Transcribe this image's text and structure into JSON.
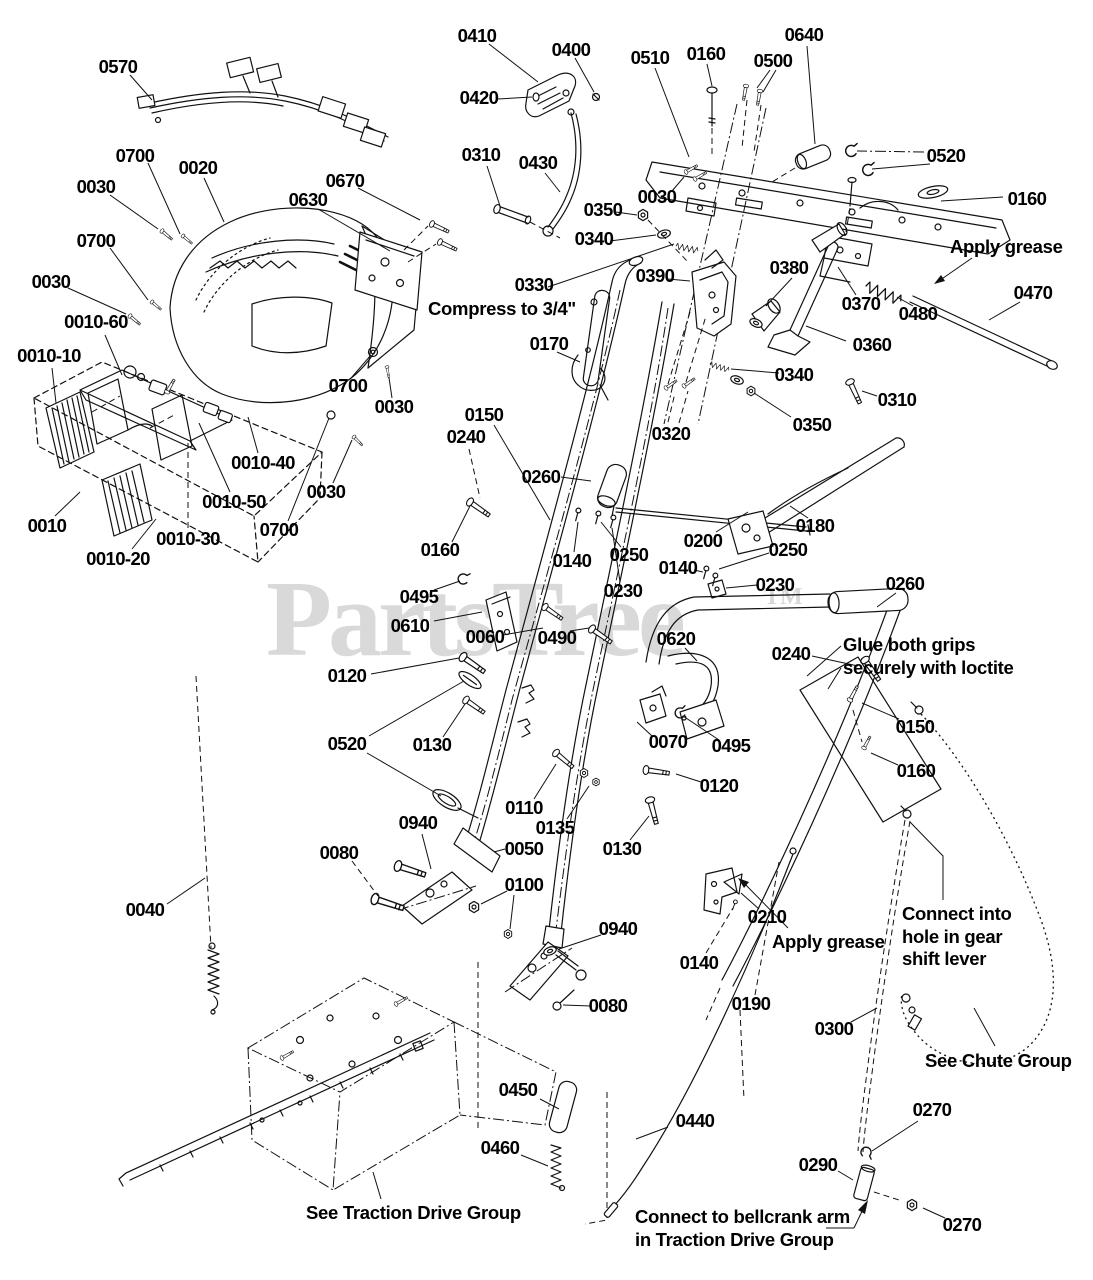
{
  "watermark": {
    "text": "PartsTree",
    "tm": "TM",
    "color": "#d9d9d9"
  },
  "diagram": {
    "background": "#ffffff",
    "line_color": "#111111"
  },
  "callouts": [
    {
      "type": "part",
      "text": "0570",
      "x": 118,
      "y": 67
    },
    {
      "type": "part",
      "text": "0700",
      "x": 135,
      "y": 156
    },
    {
      "type": "part",
      "text": "0020",
      "x": 198,
      "y": 168
    },
    {
      "type": "part",
      "text": "0030",
      "x": 96,
      "y": 187
    },
    {
      "type": "part",
      "text": "0670",
      "x": 345,
      "y": 181
    },
    {
      "type": "part",
      "text": "0630",
      "x": 308,
      "y": 200
    },
    {
      "type": "part",
      "text": "0700",
      "x": 96,
      "y": 241
    },
    {
      "type": "part",
      "text": "0030",
      "x": 51,
      "y": 282
    },
    {
      "type": "part",
      "text": "0010-60",
      "x": 96,
      "y": 322
    },
    {
      "type": "part",
      "text": "0010-10",
      "x": 49,
      "y": 356
    },
    {
      "type": "part",
      "text": "0700",
      "x": 348,
      "y": 386
    },
    {
      "type": "part",
      "text": "0030",
      "x": 394,
      "y": 407
    },
    {
      "type": "part",
      "text": "0010-40",
      "x": 263,
      "y": 463
    },
    {
      "type": "part",
      "text": "0010-50",
      "x": 234,
      "y": 502
    },
    {
      "type": "part",
      "text": "0030",
      "x": 326,
      "y": 492
    },
    {
      "type": "part",
      "text": "0010",
      "x": 47,
      "y": 526
    },
    {
      "type": "part",
      "text": "0010-30",
      "x": 188,
      "y": 539
    },
    {
      "type": "part",
      "text": "0700",
      "x": 279,
      "y": 530
    },
    {
      "type": "part",
      "text": "0010-20",
      "x": 118,
      "y": 559
    },
    {
      "type": "part",
      "text": "0410",
      "x": 477,
      "y": 36
    },
    {
      "type": "part",
      "text": "0400",
      "x": 571,
      "y": 50
    },
    {
      "type": "part",
      "text": "0510",
      "x": 650,
      "y": 58
    },
    {
      "type": "part",
      "text": "0160",
      "x": 706,
      "y": 54
    },
    {
      "type": "part",
      "text": "0500",
      "x": 773,
      "y": 61
    },
    {
      "type": "part",
      "text": "0640",
      "x": 804,
      "y": 35
    },
    {
      "type": "part",
      "text": "0420",
      "x": 479,
      "y": 98
    },
    {
      "type": "part",
      "text": "0310",
      "x": 481,
      "y": 155
    },
    {
      "type": "part",
      "text": "0430",
      "x": 538,
      "y": 163
    },
    {
      "type": "part",
      "text": "0030",
      "x": 657,
      "y": 197
    },
    {
      "type": "part",
      "text": "0350",
      "x": 603,
      "y": 210
    },
    {
      "type": "part",
      "text": "0340",
      "x": 594,
      "y": 239
    },
    {
      "type": "part",
      "text": "0330",
      "x": 534,
      "y": 285
    },
    {
      "type": "part",
      "text": "0390",
      "x": 655,
      "y": 276
    },
    {
      "type": "part",
      "text": "0380",
      "x": 789,
      "y": 268
    },
    {
      "type": "part",
      "text": "0370",
      "x": 861,
      "y": 304
    },
    {
      "type": "part",
      "text": "0360",
      "x": 872,
      "y": 345
    },
    {
      "type": "part",
      "text": "0520",
      "x": 946,
      "y": 156
    },
    {
      "type": "part",
      "text": "0160",
      "x": 1027,
      "y": 199
    },
    {
      "type": "part",
      "text": "0470",
      "x": 1033,
      "y": 293
    },
    {
      "type": "part",
      "text": "0480",
      "x": 918,
      "y": 314
    },
    {
      "type": "part",
      "text": "0340",
      "x": 794,
      "y": 375
    },
    {
      "type": "part",
      "text": "0310",
      "x": 897,
      "y": 400
    },
    {
      "type": "part",
      "text": "0350",
      "x": 812,
      "y": 425
    },
    {
      "type": "part",
      "text": "0320",
      "x": 671,
      "y": 434
    },
    {
      "type": "part",
      "text": "0170",
      "x": 549,
      "y": 344
    },
    {
      "type": "part",
      "text": "0150",
      "x": 484,
      "y": 415
    },
    {
      "type": "part",
      "text": "0240",
      "x": 466,
      "y": 437
    },
    {
      "type": "part",
      "text": "0260",
      "x": 541,
      "y": 477
    },
    {
      "type": "part",
      "text": "0200",
      "x": 703,
      "y": 541
    },
    {
      "type": "part",
      "text": "0180",
      "x": 815,
      "y": 526
    },
    {
      "type": "part",
      "text": "0160",
      "x": 440,
      "y": 550
    },
    {
      "type": "part",
      "text": "0140",
      "x": 572,
      "y": 561
    },
    {
      "type": "part",
      "text": "0250",
      "x": 629,
      "y": 555
    },
    {
      "type": "part",
      "text": "0230",
      "x": 623,
      "y": 591
    },
    {
      "type": "part",
      "text": "0140",
      "x": 678,
      "y": 568
    },
    {
      "type": "part",
      "text": "0250",
      "x": 788,
      "y": 550
    },
    {
      "type": "part",
      "text": "0230",
      "x": 775,
      "y": 585
    },
    {
      "type": "part",
      "text": "0260",
      "x": 905,
      "y": 584
    },
    {
      "type": "part",
      "text": "0620",
      "x": 676,
      "y": 639
    },
    {
      "type": "part",
      "text": "0240",
      "x": 791,
      "y": 654
    },
    {
      "type": "part",
      "text": "0495",
      "x": 419,
      "y": 597
    },
    {
      "type": "part",
      "text": "0610",
      "x": 410,
      "y": 626
    },
    {
      "type": "part",
      "text": "0060",
      "x": 485,
      "y": 637
    },
    {
      "type": "part",
      "text": "0490",
      "x": 557,
      "y": 638
    },
    {
      "type": "part",
      "text": "0120",
      "x": 347,
      "y": 676
    },
    {
      "type": "part",
      "text": "0520",
      "x": 347,
      "y": 744
    },
    {
      "type": "part",
      "text": "0130",
      "x": 432,
      "y": 745
    },
    {
      "type": "part",
      "text": "0070",
      "x": 668,
      "y": 742
    },
    {
      "type": "part",
      "text": "0495",
      "x": 731,
      "y": 746
    },
    {
      "type": "part",
      "text": "0120",
      "x": 719,
      "y": 786
    },
    {
      "type": "part",
      "text": "0110",
      "x": 524,
      "y": 808
    },
    {
      "type": "part",
      "text": "0135",
      "x": 555,
      "y": 828
    },
    {
      "type": "part",
      "text": "0940",
      "x": 418,
      "y": 823
    },
    {
      "type": "part",
      "text": "0050",
      "x": 524,
      "y": 849
    },
    {
      "type": "part",
      "text": "0080",
      "x": 339,
      "y": 853
    },
    {
      "type": "part",
      "text": "0130",
      "x": 622,
      "y": 849
    },
    {
      "type": "part",
      "text": "0150",
      "x": 915,
      "y": 727
    },
    {
      "type": "part",
      "text": "0160",
      "x": 916,
      "y": 771
    },
    {
      "type": "part",
      "text": "0100",
      "x": 524,
      "y": 885
    },
    {
      "type": "part",
      "text": "0040",
      "x": 145,
      "y": 910
    },
    {
      "type": "part",
      "text": "0940",
      "x": 618,
      "y": 929
    },
    {
      "type": "part",
      "text": "0080",
      "x": 608,
      "y": 1006
    },
    {
      "type": "part",
      "text": "0210",
      "x": 767,
      "y": 917
    },
    {
      "type": "part",
      "text": "0140",
      "x": 699,
      "y": 963
    },
    {
      "type": "part",
      "text": "0190",
      "x": 751,
      "y": 1004
    },
    {
      "type": "part",
      "text": "0300",
      "x": 834,
      "y": 1029
    },
    {
      "type": "part",
      "text": "0450",
      "x": 518,
      "y": 1090
    },
    {
      "type": "part",
      "text": "0460",
      "x": 500,
      "y": 1148
    },
    {
      "type": "part",
      "text": "0440",
      "x": 695,
      "y": 1121
    },
    {
      "type": "part",
      "text": "0290",
      "x": 818,
      "y": 1165
    },
    {
      "type": "part",
      "text": "0270",
      "x": 932,
      "y": 1110
    },
    {
      "type": "part",
      "text": "0270",
      "x": 962,
      "y": 1225
    },
    {
      "type": "note",
      "text": "Compress to 3/4\"",
      "x": 428,
      "y": 298
    },
    {
      "type": "note",
      "text": "Apply grease",
      "x": 950,
      "y": 236
    },
    {
      "type": "note",
      "text": "Glue both grips\nsecurely with loctite",
      "x": 843,
      "y": 634
    },
    {
      "type": "note",
      "text": "Apply grease",
      "x": 772,
      "y": 931
    },
    {
      "type": "note",
      "text": "Connect into\nhole in gear\nshift lever",
      "x": 902,
      "y": 903
    },
    {
      "type": "note",
      "text": "See Chute Group",
      "x": 925,
      "y": 1050
    },
    {
      "type": "note",
      "text": "See Traction Drive Group",
      "x": 306,
      "y": 1202
    },
    {
      "type": "note",
      "text": "Connect to bellcrank arm\nin Traction Drive Group",
      "x": 635,
      "y": 1206
    }
  ]
}
